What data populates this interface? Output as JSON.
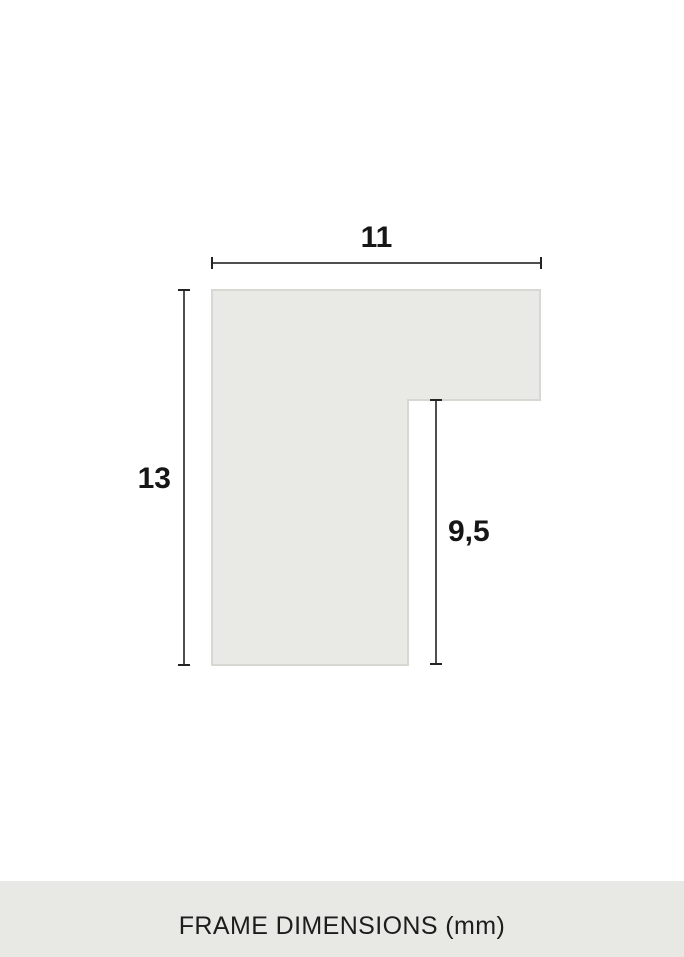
{
  "diagram": {
    "type": "frame-profile-cross-section",
    "dimensions": [
      {
        "name": "outer-width",
        "value": "11"
      },
      {
        "name": "outer-height",
        "value": "13"
      },
      {
        "name": "inner-height",
        "value": "9,5"
      }
    ]
  },
  "footer": {
    "label": "FRAME DIMENSIONS (mm)"
  },
  "colors": {
    "shape_fill": "#e9e9e6",
    "shape_border": "#d8d8d3",
    "dimension_line": "#4f4f4f",
    "tick": "#242424",
    "text": "#161616",
    "footer_background": "#e8e8e4"
  }
}
